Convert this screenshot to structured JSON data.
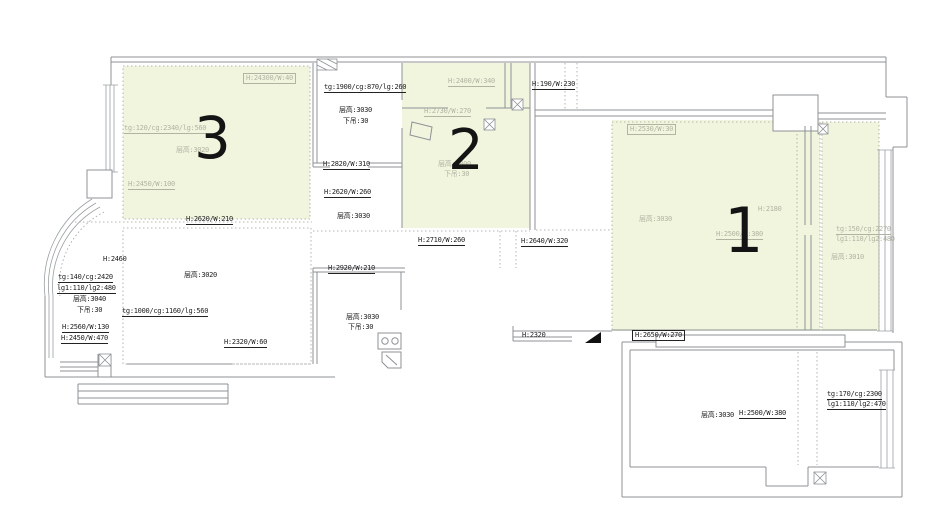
{
  "plan": {
    "canvas": {
      "width": 952,
      "height": 527
    },
    "colors": {
      "room_highlight": "#f1f5de",
      "wall_line": "#8d9296",
      "gray_annotation": "#b2b4a3",
      "black_annotation": "#222222",
      "entry_marker": "#111111"
    },
    "rooms": [
      {
        "number": "1",
        "x": 724,
        "y": 194,
        "size": 62
      },
      {
        "number": "2",
        "x": 448,
        "y": 118,
        "size": 56
      },
      {
        "number": "3",
        "x": 194,
        "y": 104,
        "size": 58
      }
    ],
    "icons": {
      "stove": "stove-icon",
      "sink": "sink-icon",
      "entry_marker": "entry-marker-icon",
      "vent": "vent-icon",
      "bay_window": "bay-window-arc"
    },
    "labels": [
      {
        "text": "H:24300/W:40",
        "x": 243,
        "y": 73,
        "color": "gray",
        "boxed": true
      },
      {
        "text": "tg:120/cg:2340/lg:560",
        "x": 124,
        "y": 124,
        "color": "gray",
        "u": true
      },
      {
        "text": "层高:3020",
        "x": 176,
        "y": 146,
        "color": "gray"
      },
      {
        "text": "H:2450/W:100",
        "x": 128,
        "y": 180,
        "color": "gray",
        "u": true
      },
      {
        "text": "H:2620/W:210",
        "x": 186,
        "y": 215,
        "color": "black",
        "u": true
      },
      {
        "text": "tg:1900/cg:870/lg:260",
        "x": 324,
        "y": 83,
        "color": "black",
        "u": true
      },
      {
        "text": "层高:3030",
        "x": 339,
        "y": 106,
        "color": "black"
      },
      {
        "text": "下吊:30",
        "x": 343,
        "y": 117,
        "color": "black"
      },
      {
        "text": "H:2820/W:310",
        "x": 323,
        "y": 160,
        "color": "black",
        "u": true
      },
      {
        "text": "H:2620/W:260",
        "x": 324,
        "y": 188,
        "color": "black",
        "u": true
      },
      {
        "text": "层高:3030",
        "x": 337,
        "y": 212,
        "color": "black"
      },
      {
        "text": "H:2400/W:340",
        "x": 448,
        "y": 77,
        "color": "gray",
        "u": true
      },
      {
        "text": "H:190/W:230",
        "x": 532,
        "y": 80,
        "color": "black",
        "u": true
      },
      {
        "text": "H:2730/W:270",
        "x": 424,
        "y": 107,
        "color": "gray",
        "u": true
      },
      {
        "text": "层高:3000",
        "x": 438,
        "y": 160,
        "color": "gray"
      },
      {
        "text": "下吊:30",
        "x": 444,
        "y": 170,
        "color": "gray"
      },
      {
        "text": "H:2530/W:30",
        "x": 627,
        "y": 124,
        "color": "gray",
        "boxed": true
      },
      {
        "text": "层高:3030",
        "x": 639,
        "y": 215,
        "color": "gray"
      },
      {
        "text": "H:2180",
        "x": 758,
        "y": 205,
        "color": "gray"
      },
      {
        "text": "H:2500/W:380",
        "x": 716,
        "y": 230,
        "color": "gray",
        "u": true
      },
      {
        "text": "tg:150/cg:2270",
        "x": 836,
        "y": 225,
        "color": "gray",
        "u": true
      },
      {
        "text": "lg1:110/lg2:480",
        "x": 836,
        "y": 235,
        "color": "gray"
      },
      {
        "text": "层高:3010",
        "x": 831,
        "y": 253,
        "color": "gray"
      },
      {
        "text": "H:2460",
        "x": 103,
        "y": 255,
        "color": "black"
      },
      {
        "text": "tg:140/cg:2420",
        "x": 58,
        "y": 273,
        "color": "black",
        "u": true
      },
      {
        "text": "lg1:110/lg2:480",
        "x": 57,
        "y": 284,
        "color": "black",
        "u": true
      },
      {
        "text": "层高:3040",
        "x": 73,
        "y": 295,
        "color": "black"
      },
      {
        "text": "下吊:30",
        "x": 77,
        "y": 306,
        "color": "black"
      },
      {
        "text": "H:2560/W:130",
        "x": 62,
        "y": 323,
        "color": "black",
        "u": true
      },
      {
        "text": "H:2450/W:470",
        "x": 61,
        "y": 334,
        "color": "black",
        "u": true
      },
      {
        "text": "层高:3020",
        "x": 184,
        "y": 271,
        "color": "black"
      },
      {
        "text": "tg:1000/cg:1160/lg:560",
        "x": 122,
        "y": 307,
        "color": "black",
        "u": true
      },
      {
        "text": "H:2320/W:60",
        "x": 224,
        "y": 338,
        "color": "black",
        "u": true
      },
      {
        "text": "H:2710/W:260",
        "x": 418,
        "y": 236,
        "color": "black",
        "u": true
      },
      {
        "text": "H:2640/W:320",
        "x": 521,
        "y": 237,
        "color": "black",
        "u": true
      },
      {
        "text": "H:2920/W:210",
        "x": 328,
        "y": 264,
        "color": "black",
        "u": true
      },
      {
        "text": "层高:3030",
        "x": 346,
        "y": 313,
        "color": "black"
      },
      {
        "text": "下吊:30",
        "x": 348,
        "y": 323,
        "color": "black"
      },
      {
        "text": "H:2320",
        "x": 522,
        "y": 331,
        "color": "black"
      },
      {
        "text": "H:2650/W:270",
        "x": 632,
        "y": 330,
        "color": "black",
        "boxed": true
      },
      {
        "text": "H:2500/W:380",
        "x": 739,
        "y": 409,
        "color": "black",
        "u": true
      },
      {
        "text": "层高:3030",
        "x": 701,
        "y": 411,
        "color": "black"
      },
      {
        "text": "tg:170/cg:2300",
        "x": 827,
        "y": 390,
        "color": "black",
        "u": true
      },
      {
        "text": "lg1:110/lg2:470",
        "x": 827,
        "y": 400,
        "color": "black",
        "u": true
      }
    ]
  }
}
